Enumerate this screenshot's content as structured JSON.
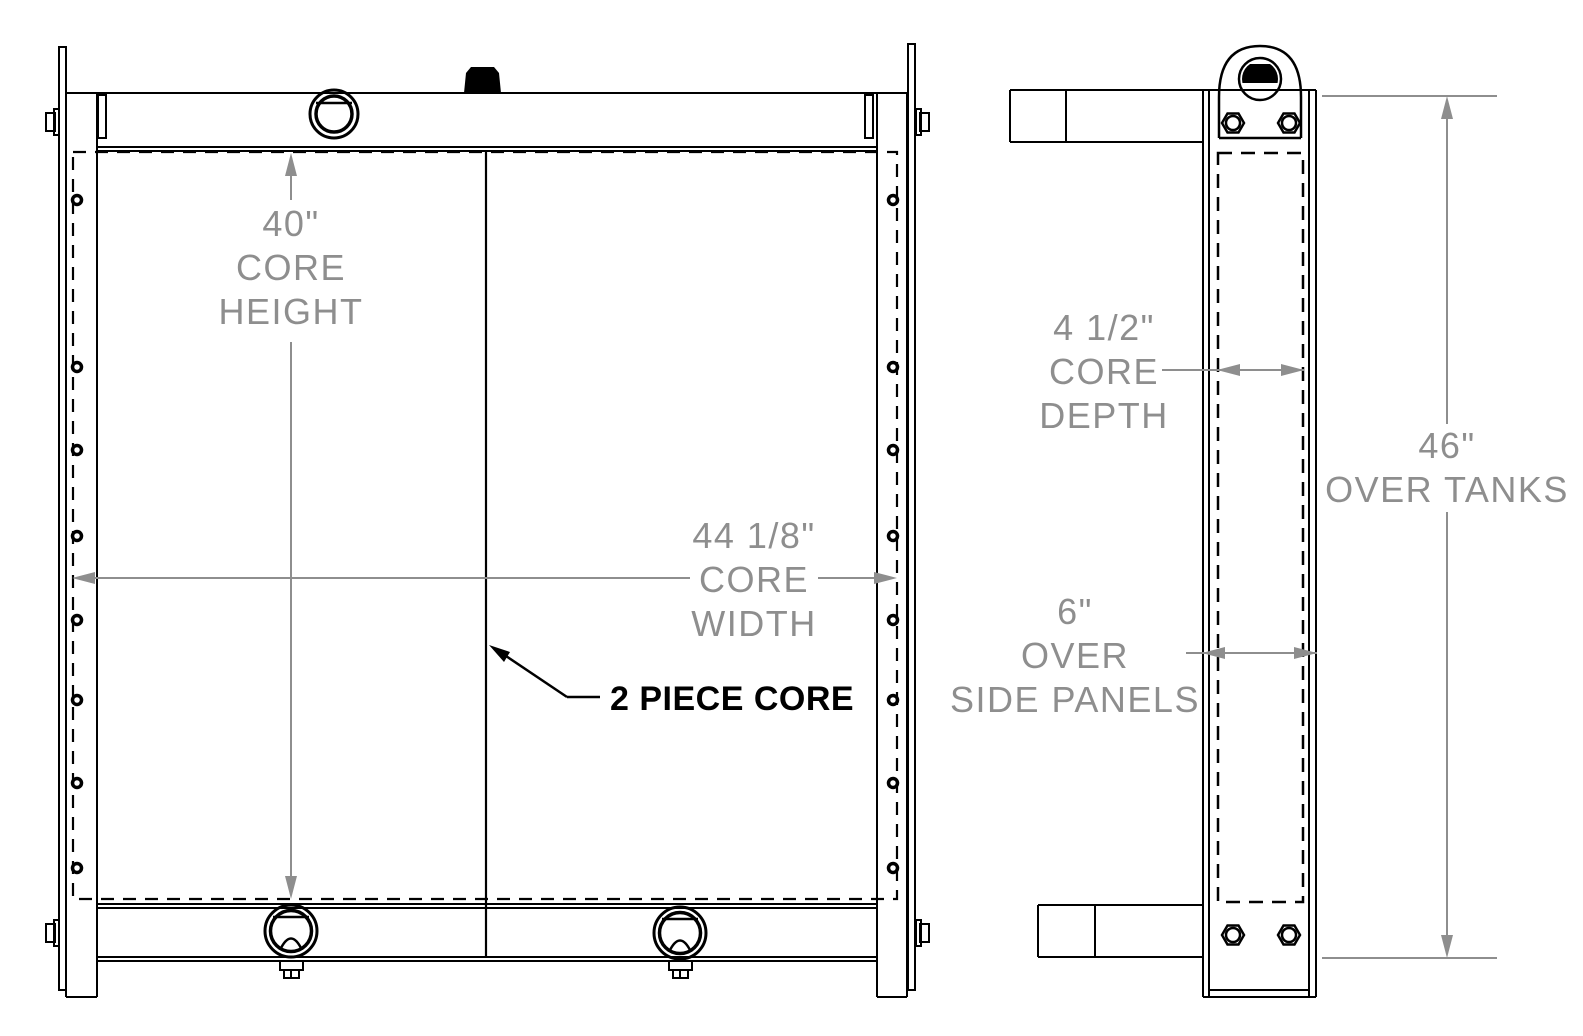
{
  "labels": {
    "core_height": [
      "40\"",
      "CORE",
      "HEIGHT"
    ],
    "core_width": [
      "44 1/8\"",
      "CORE",
      "WIDTH"
    ],
    "two_piece_core": "2 PIECE CORE",
    "core_depth": [
      "4 1/2\"",
      "CORE",
      "DEPTH"
    ],
    "over_tanks": [
      "46\"",
      "OVER TANKS"
    ],
    "over_side_panels": [
      "6\"",
      "OVER",
      "SIDE PANELS"
    ]
  },
  "colors": {
    "line": "#000000",
    "dimension": "#8e8e8e",
    "background": "#ffffff"
  }
}
